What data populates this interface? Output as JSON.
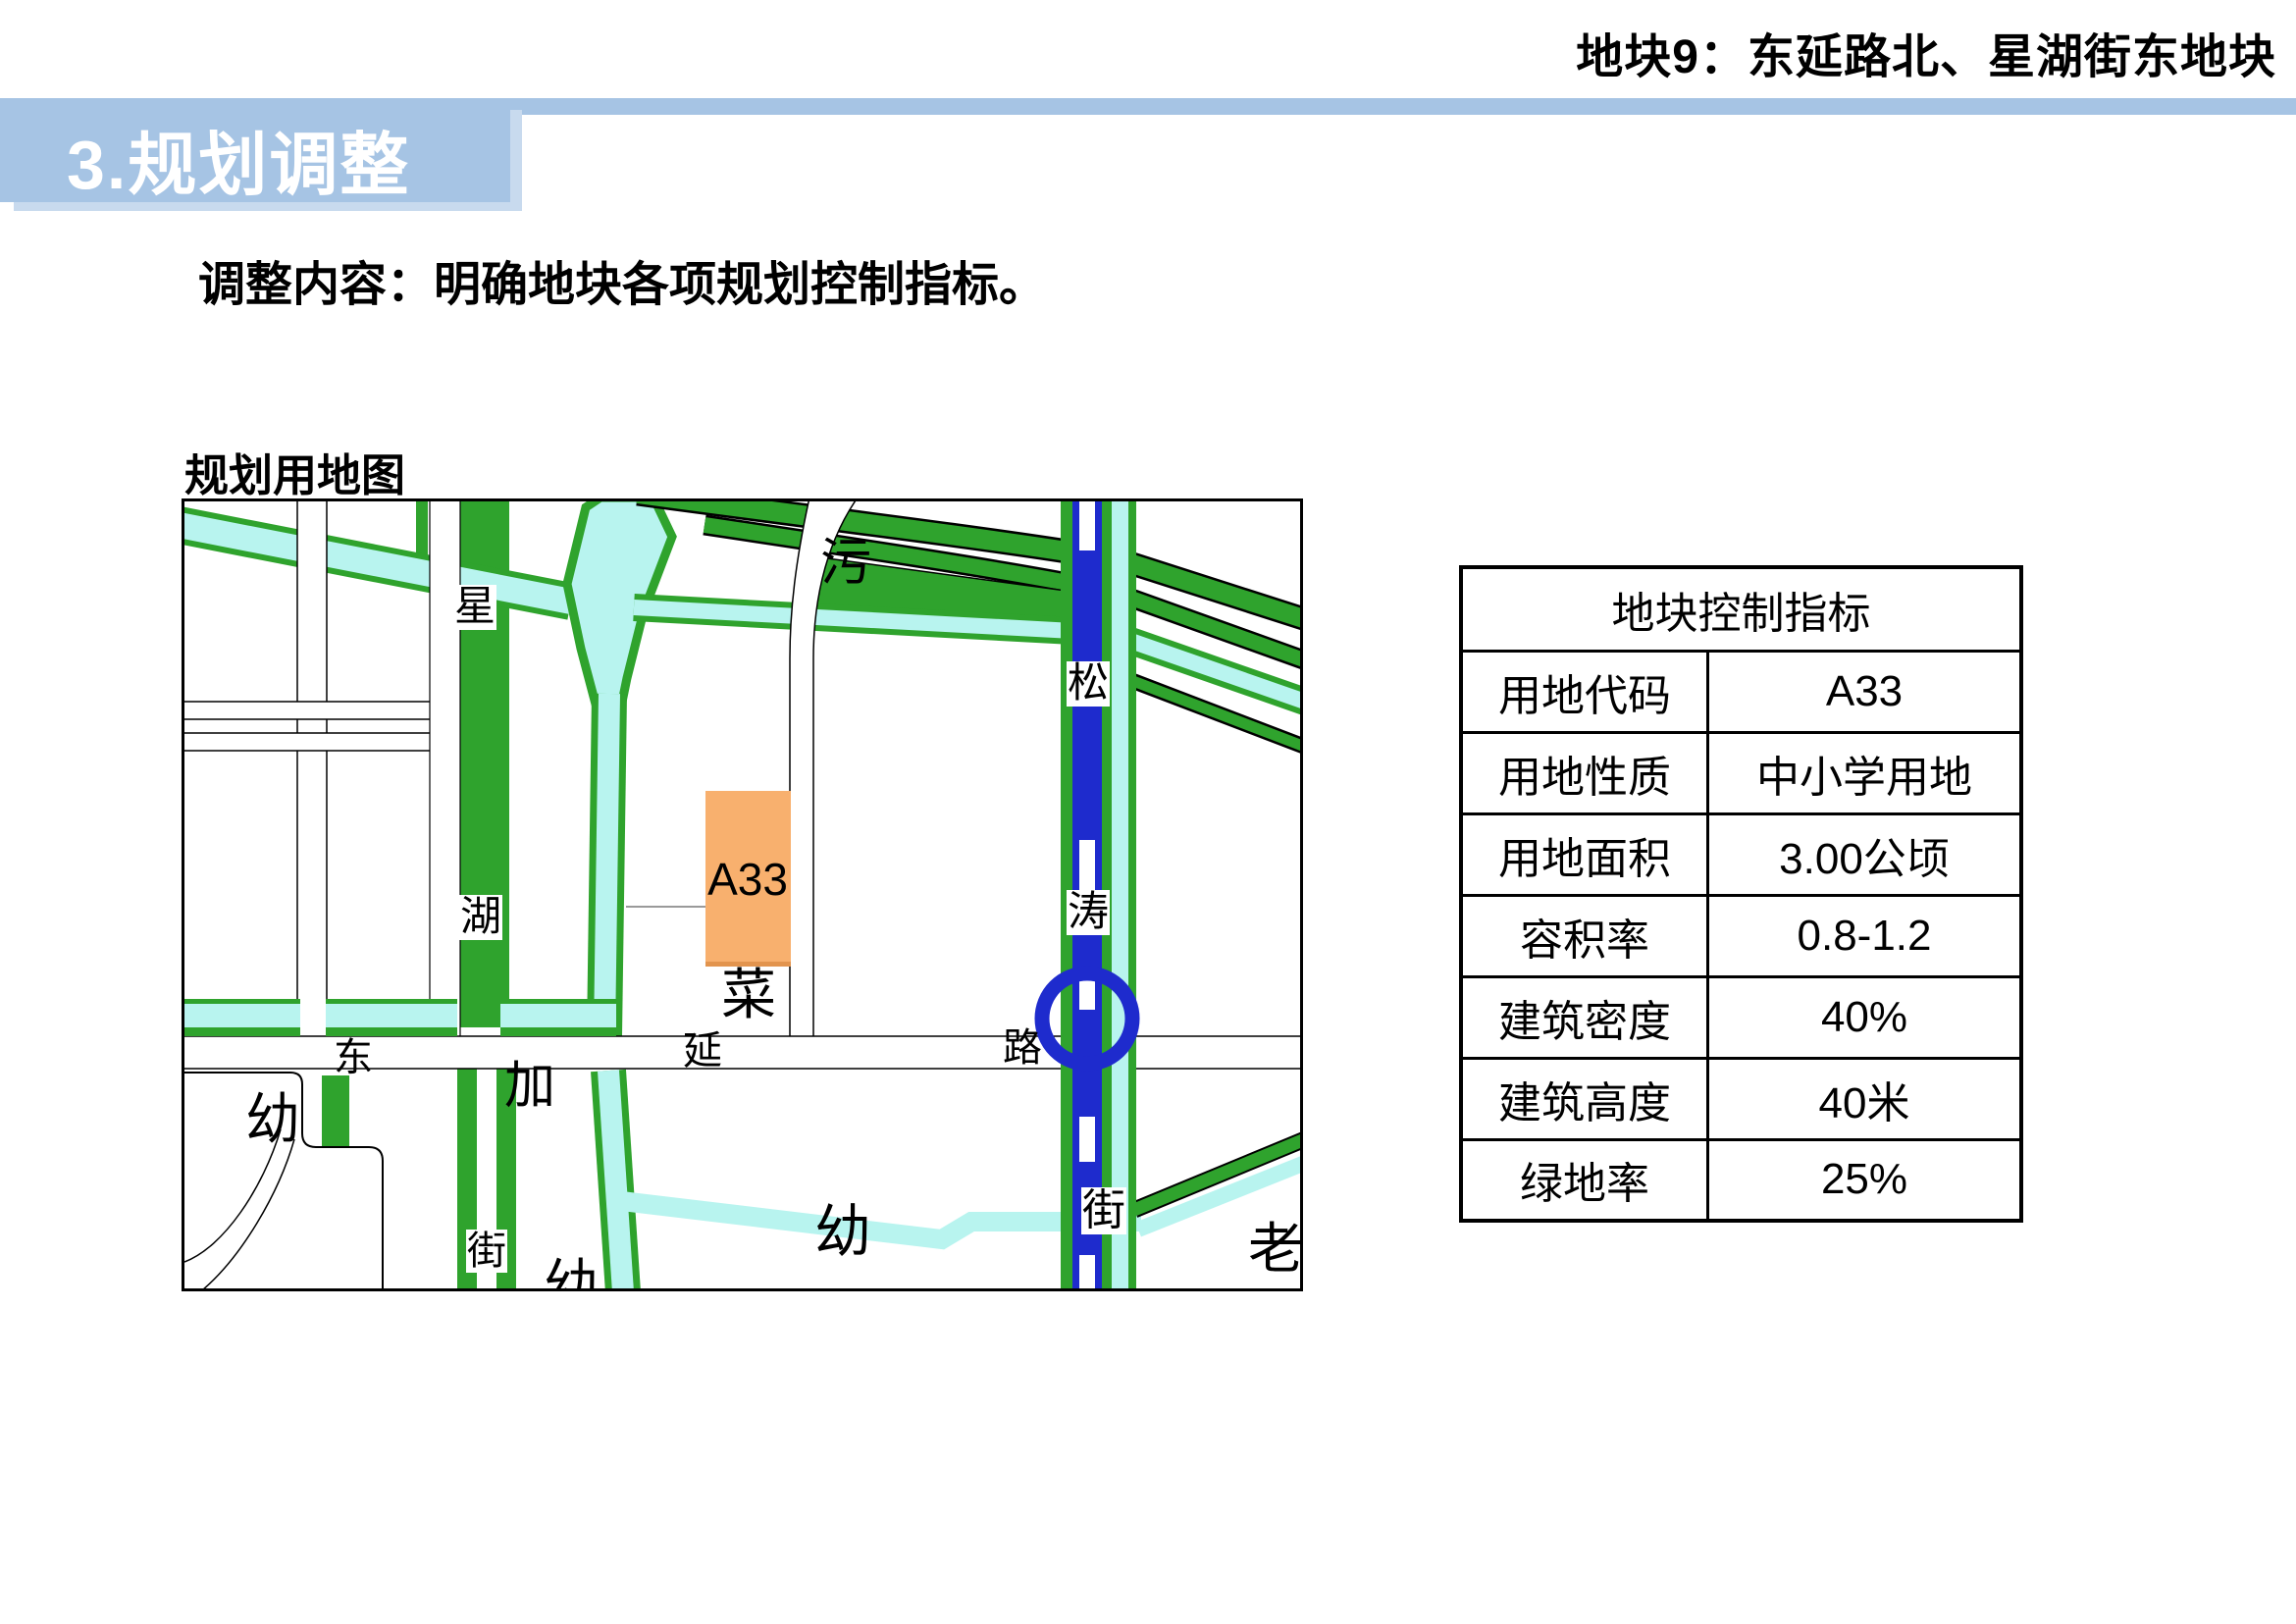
{
  "page": {
    "header_right": "地块9：东延路北、星湖街东地块",
    "section_title": "3.规划调整",
    "body_text": "调整内容：明确地块各项规划控制指标。",
    "map_caption": "规划用地图"
  },
  "colors": {
    "accent_blue": "#a6c4e4",
    "accent_blue_light": "#c8daee",
    "map_green": "#2fa32d",
    "map_cyan": "#b8f4ef",
    "map_road_blue": "#1e2bcd",
    "parcel_orange": "#f8b06e",
    "parcel_orange_edge": "#e2944e"
  },
  "map": {
    "parcel_label": "A33",
    "labels": {
      "xing": "星",
      "hu": "湖",
      "jie_xinghu": "街",
      "song": "松",
      "tao": "涛",
      "jie_songtao": "街",
      "dong": "东",
      "yan": "延",
      "lu": "路",
      "wu": "污",
      "cai": "菜",
      "jia": "加",
      "you_left": "幼",
      "you_bottom": "幼",
      "you_center": "幼",
      "lao": "老"
    }
  },
  "table": {
    "title": "地块控制指标",
    "rows": [
      {
        "label": "用地代码",
        "value": "A33"
      },
      {
        "label": "用地性质",
        "value": "中小学用地"
      },
      {
        "label": "用地面积",
        "value": "3.00公顷"
      },
      {
        "label": "容积率",
        "value": "0.8-1.2"
      },
      {
        "label": "建筑密度",
        "value": "40%"
      },
      {
        "label": "建筑高度",
        "value": "40米"
      },
      {
        "label": "绿地率",
        "value": "25%"
      }
    ]
  }
}
